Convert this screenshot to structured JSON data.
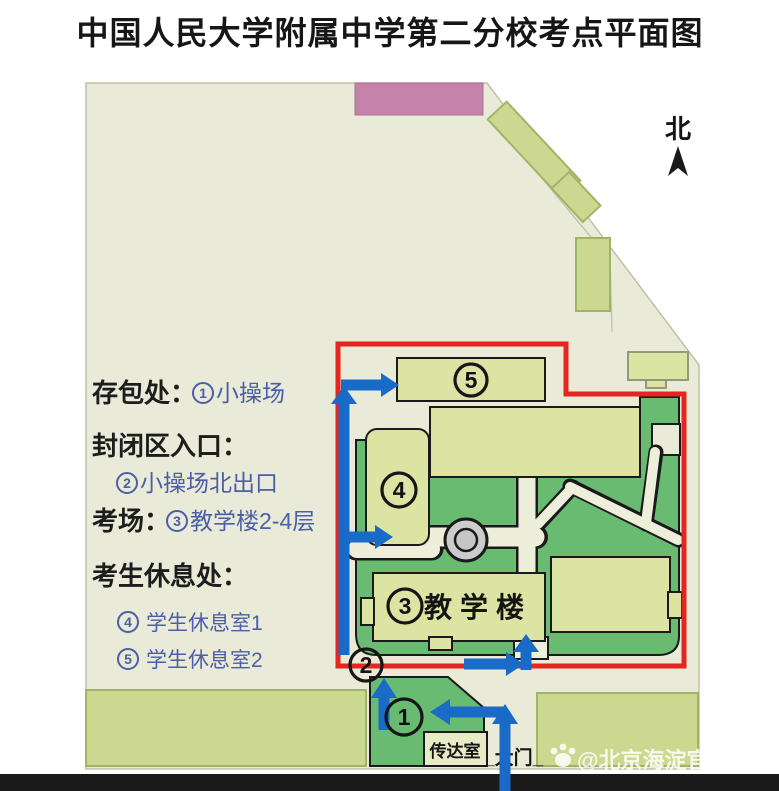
{
  "title": "中国人民大学附属中学第二分校考点平面图",
  "north_label": "北",
  "legend": {
    "bag_storage_label": "存包处：",
    "bag_storage_value": "小操场",
    "closed_entrance_label": "封闭区入口：",
    "closed_entrance_value": "小操场北出口",
    "exam_room_label": "考场：",
    "exam_room_value": "教学楼2-4层",
    "rest_area_label": "考生休息处：",
    "rest_room1_value": "学生休息室1",
    "rest_room2_value": "学生休息室2",
    "num1": "1",
    "num2": "2",
    "num3": "3",
    "num4": "4",
    "num5": "5"
  },
  "map": {
    "markers": {
      "m1": "1",
      "m2": "2",
      "m3": "3",
      "m4": "4",
      "m5": "5"
    },
    "teaching_building_label": "教学楼",
    "reception_label": "传达室",
    "gate_label": "_大门_"
  },
  "watermark": "@北京海淀官方发布",
  "colors": {
    "boundary_red": "#e42520",
    "route_blue": "#1a6bc7",
    "legend_blue": "#4a5fa8",
    "lawn_green": "#68bb70",
    "building_pale_green": "#dce4a4",
    "building_olive": "#ccd88f",
    "campus_beige": "#e9ebd8",
    "building_pink": "#c583ab"
  }
}
